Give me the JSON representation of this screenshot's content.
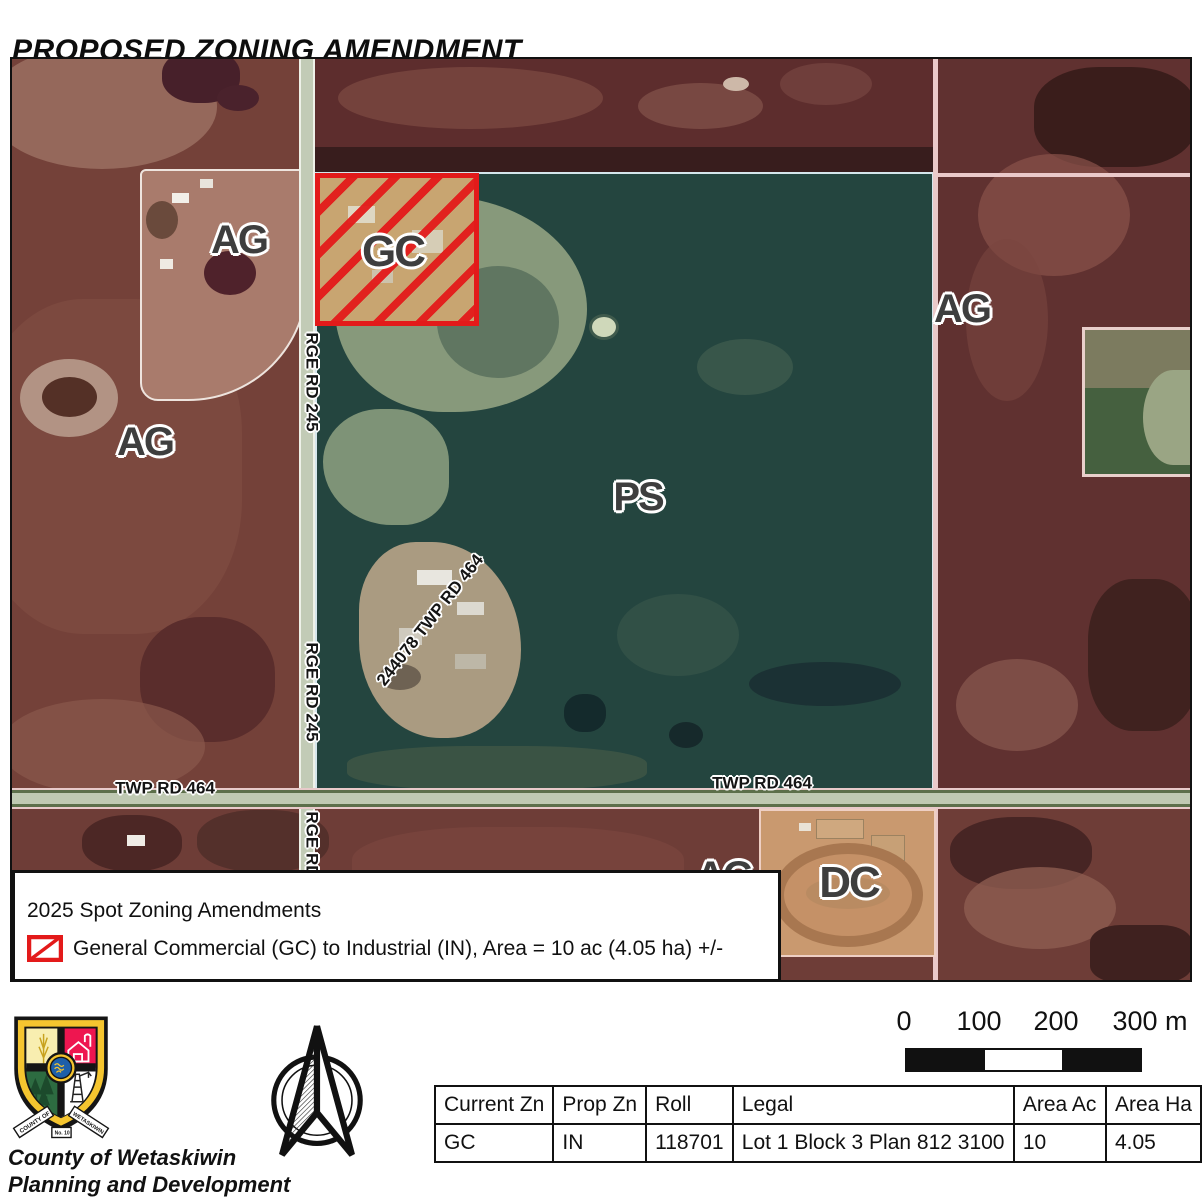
{
  "title": "PROPOSED ZONING AMENDMENT",
  "map": {
    "zone_labels": [
      {
        "text": "AG",
        "x": 227,
        "y": 181,
        "size": 40,
        "rot": 0
      },
      {
        "text": "AG",
        "x": 133,
        "y": 383,
        "size": 40,
        "rot": 0
      },
      {
        "text": "GC",
        "x": 381,
        "y": 193,
        "size": 44,
        "rot": 0
      },
      {
        "text": "PS",
        "x": 626,
        "y": 438,
        "size": 40,
        "rot": 0
      },
      {
        "text": "AG",
        "x": 950,
        "y": 250,
        "size": 40,
        "rot": 0
      },
      {
        "text": "AG",
        "x": 712,
        "y": 817,
        "size": 40,
        "rot": 0
      },
      {
        "text": "DC",
        "x": 837,
        "y": 824,
        "size": 44,
        "rot": 0
      }
    ],
    "road_labels": [
      {
        "text": "RGE RD 245",
        "x": 300,
        "y": 323,
        "rot": 90
      },
      {
        "text": "RGE RD 245",
        "x": 300,
        "y": 633,
        "rot": 90
      },
      {
        "text": "RGE RD 245",
        "x": 300,
        "y": 802,
        "rot": 90
      },
      {
        "text": "244078 TWP RD 464",
        "x": 418,
        "y": 561,
        "rot": -52
      },
      {
        "text": "TWP RD 464",
        "x": 153,
        "y": 729,
        "rot": 0
      },
      {
        "text": "TWP RD 464",
        "x": 750,
        "y": 724,
        "rot": 0
      }
    ],
    "legend": {
      "title": "2025 Spot Zoning Amendments",
      "item": "General Commercial (GC) to Industrial (IN), Area = 10 ac (4.05 ha) +/-"
    }
  },
  "scalebar": {
    "ticks": [
      "0",
      "100",
      "200",
      "300 m"
    ]
  },
  "table": {
    "headers": [
      "Current Zn",
      "Prop Zn",
      "Roll",
      "Legal",
      "Area Ac",
      "Area Ha"
    ],
    "rows": [
      [
        "GC",
        "IN",
        "118701",
        "Lot 1 Block 3 Plan 812 3100",
        "10",
        "4.05"
      ]
    ]
  },
  "logo": {
    "ribbon_left": "COUNTY OF",
    "ribbon_right": "WETASKIWIN",
    "ribbon_no": "No. 10"
  },
  "footer": {
    "line1": "County of Wetaskiwin",
    "line2": "Planning and Development"
  },
  "icons": {
    "north_arrow": "north-arrow-compass",
    "legend_swatch": "red-diagonal-hatch-swatch"
  },
  "colors": {
    "amendment_red": "#e31a1a",
    "gc_fill": "#c8a571",
    "ps_teal": "#24453f",
    "ag_maroon": "#6b3b35",
    "dc_orange": "#c9996f"
  }
}
